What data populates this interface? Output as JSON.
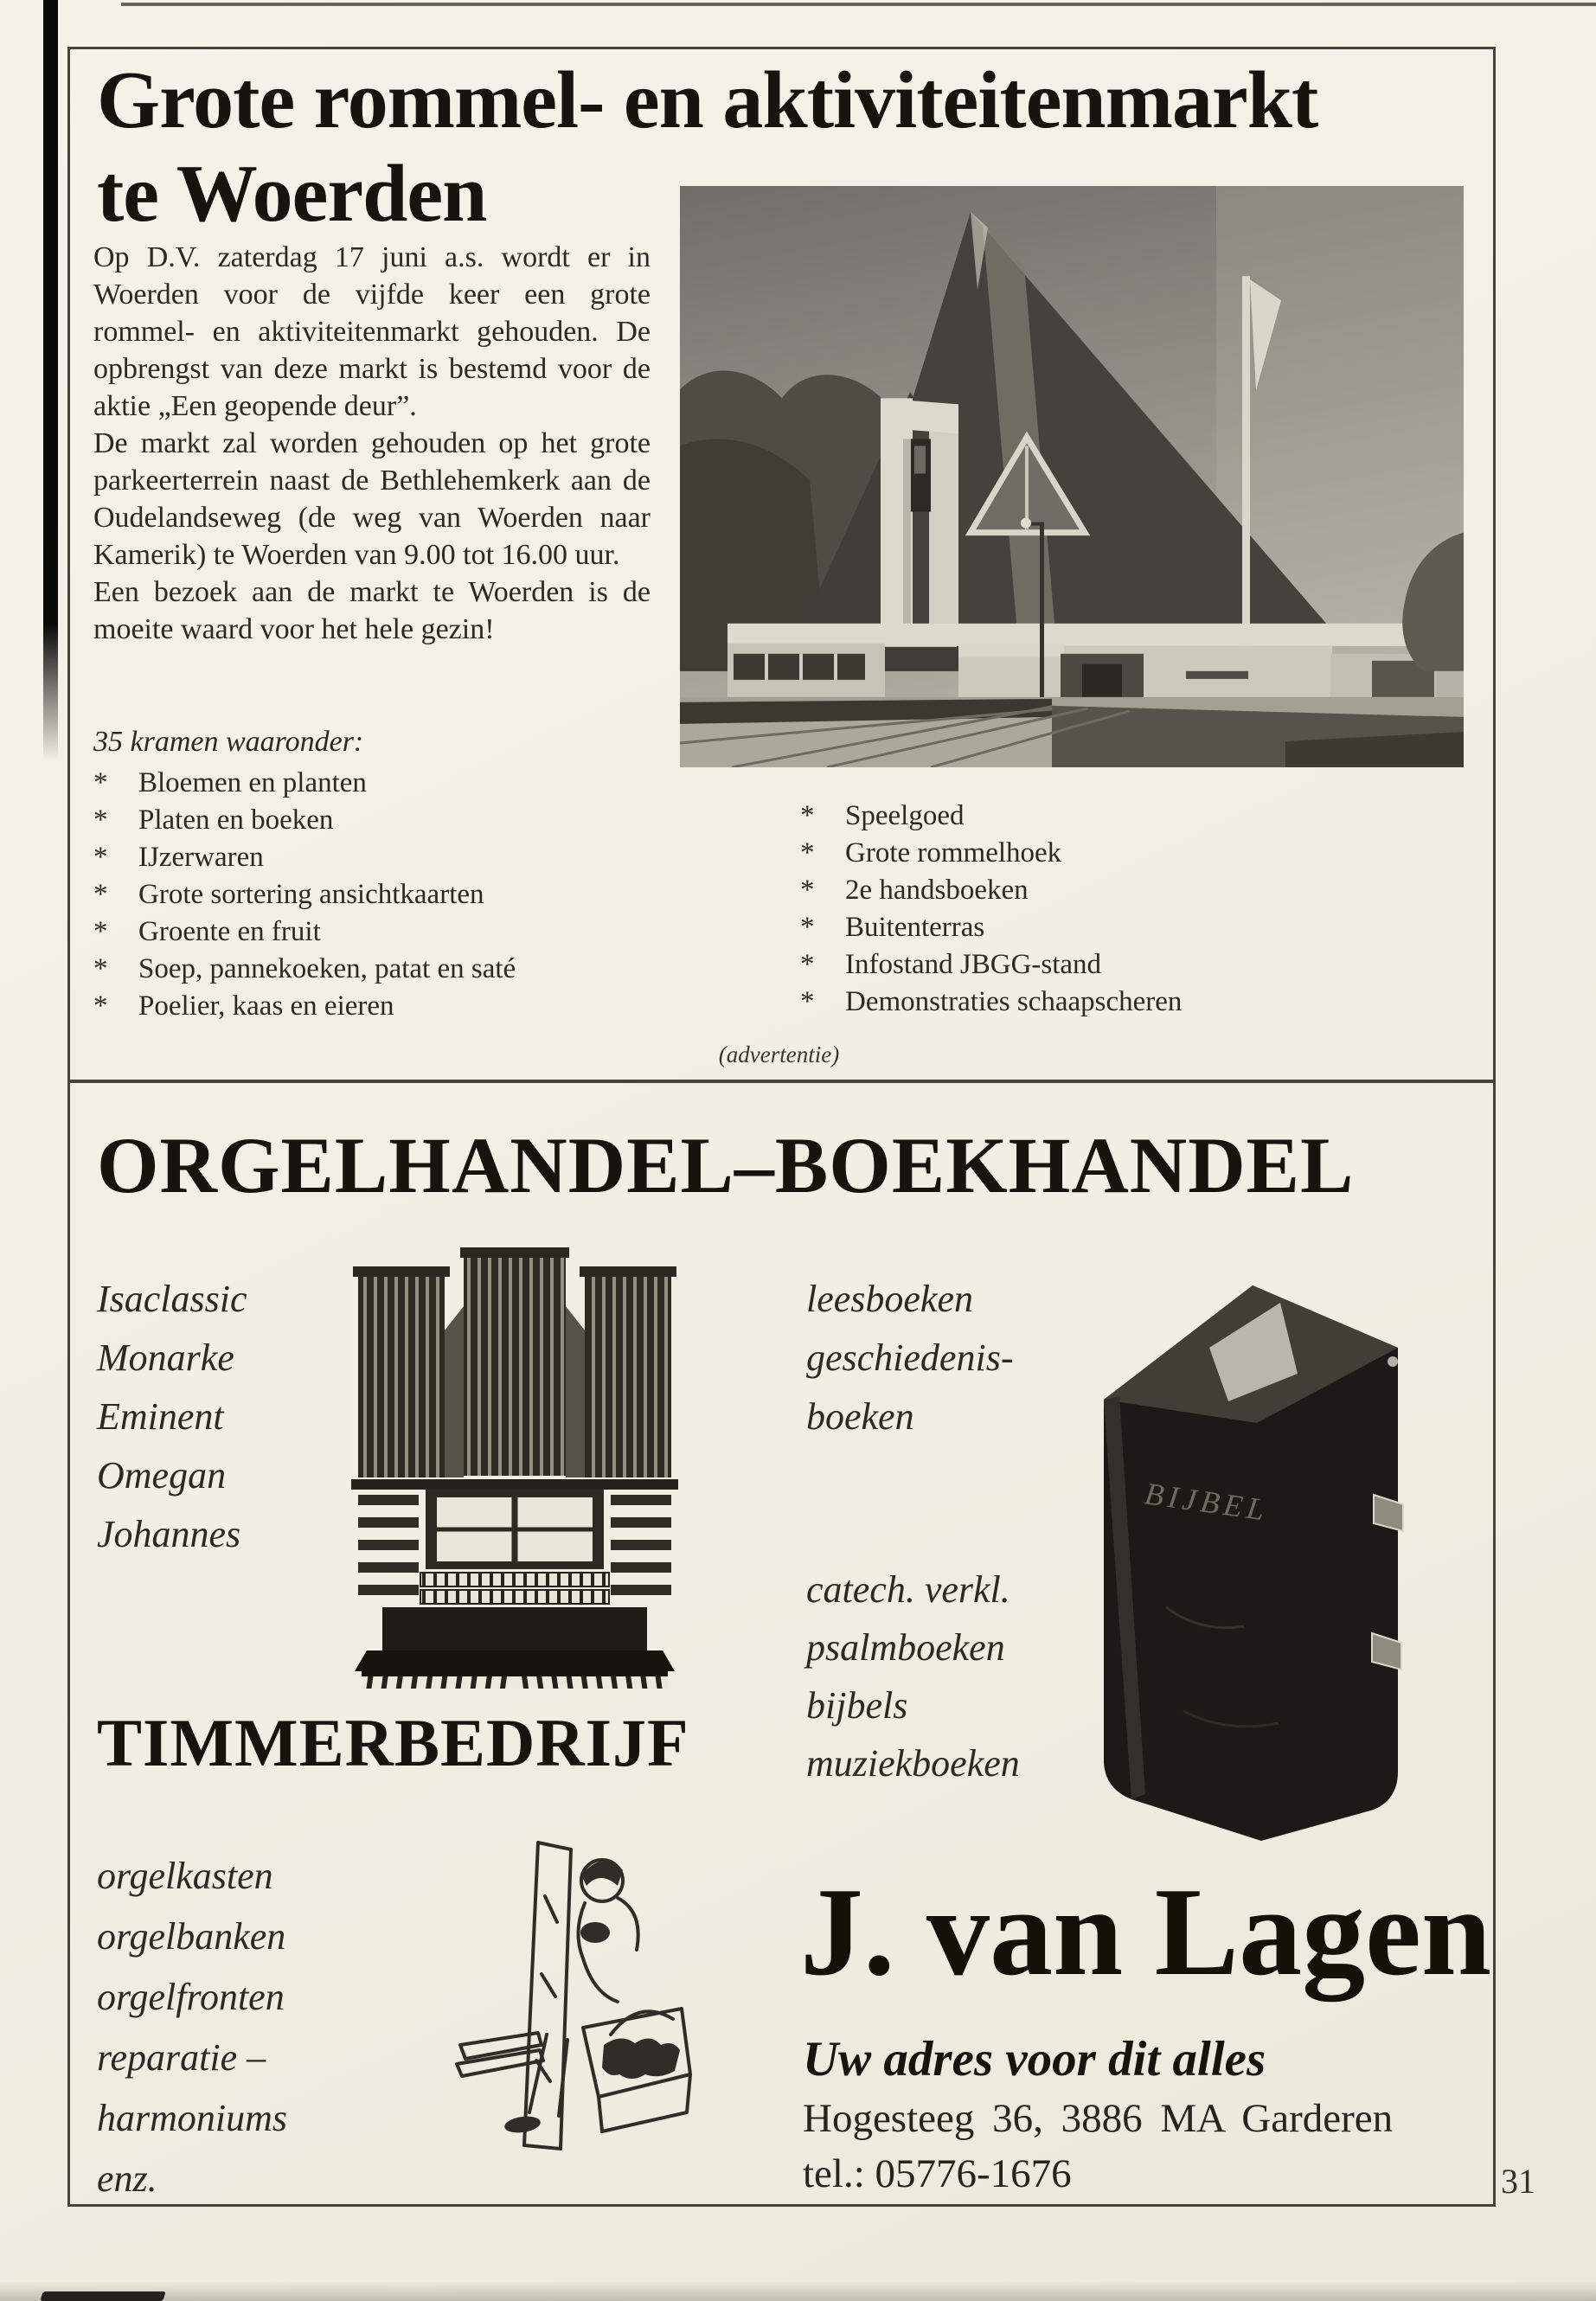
{
  "page": {
    "number": "31",
    "advert_caption": "(advertentie)",
    "bullet": "*"
  },
  "article": {
    "title_line1": "Grote rommel- en aktiviteitenmarkt",
    "title_line2": "te Woerden",
    "paragraphs": [
      "Op D.V. zaterdag 17 juni a.s. wordt er in Woerden voor de vijfde keer een grote rommel- en aktiviteitenmarkt gehouden. De opbrengst van deze markt is bestemd voor de aktie „Een geopende deur”.",
      "De markt zal worden gehouden op het grote parkeerterrein naast de Bethlehemkerk aan de Oudelandseweg (de weg van Woerden naar Kamerik) te Woerden van 9.00 tot 16.00 uur.",
      "Een bezoek aan de markt te Woerden is de moeite waard voor het hele gezin!"
    ],
    "list_intro": "35 kramen waaronder:",
    "stalls_left": [
      "Bloemen en planten",
      "Platen en boeken",
      "IJzerwaren",
      "Grote sortering ansichtkaarten",
      "Groente en fruit",
      "Soep, pannekoeken, patat en saté",
      "Poelier, kaas en eieren"
    ],
    "stalls_right": [
      "Speelgoed",
      "Grote rommelhoek",
      "2e handsboeken",
      "Buitenterras",
      "Infostand JBGG-stand",
      "Demonstraties schaapscheren"
    ]
  },
  "advert": {
    "headline_left": "ORGELHANDEL",
    "headline_separator": "–",
    "headline_right": "BOEKHANDEL",
    "organ_brands": [
      "Isaclassic",
      "Monarke",
      "Eminent",
      "Omegan",
      "Johannes"
    ],
    "book_items_top": [
      "leesboeken",
      "geschiedenis-",
      "boeken"
    ],
    "book_items_bottom": [
      "catech. verkl.",
      "psalmboeken",
      "bijbels",
      "muziekboeken"
    ],
    "book_cover_text": "BIJBEL",
    "carpentry_headline": "TIMMERBEDRIJF",
    "carpentry_items": [
      "orgelkasten",
      "orgelbanken",
      "orgelfronten",
      "reparatie –",
      "harmoniums",
      "enz."
    ],
    "company_name": "J. van Lagen",
    "tagline": "Uw adres voor dit alles",
    "address": "Hogesteeg 36, 3886 MA Garderen",
    "phone": "tel.: 05776-1676"
  }
}
